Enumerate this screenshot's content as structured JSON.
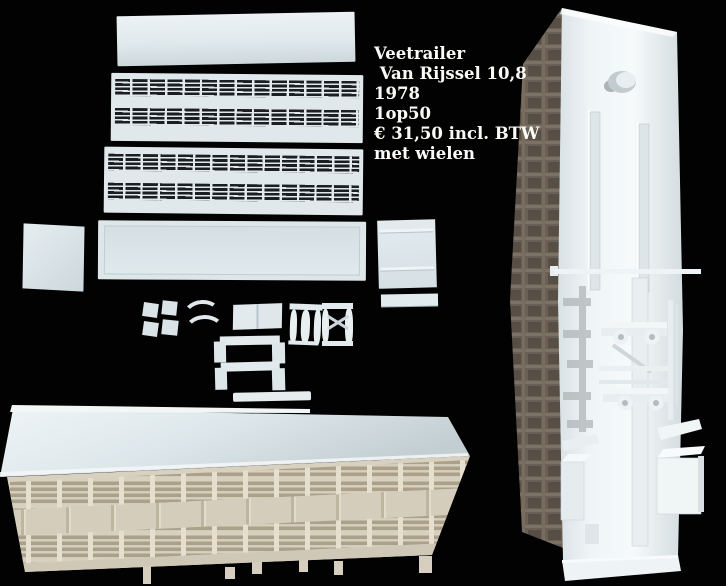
{
  "caption": {
    "lines": [
      "Veetrailer",
      " Van Rijssel 10,8",
      "1978",
      "1op50",
      "€ 31,50 incl. BTW",
      "met wielen"
    ]
  },
  "colors": {
    "background": "#020202",
    "caption_text": "#fbfaf6",
    "sprue_plastic": "#e0e8eb",
    "vent_slat_dark": "#1b1f22",
    "model_roof": "#dde7ea",
    "model_wall_cream": "#d7d0bf",
    "wall_slat": "#aba089",
    "chassis_face_white": "#f2f6f8",
    "chassis_shaded_side": "#6b6055"
  }
}
